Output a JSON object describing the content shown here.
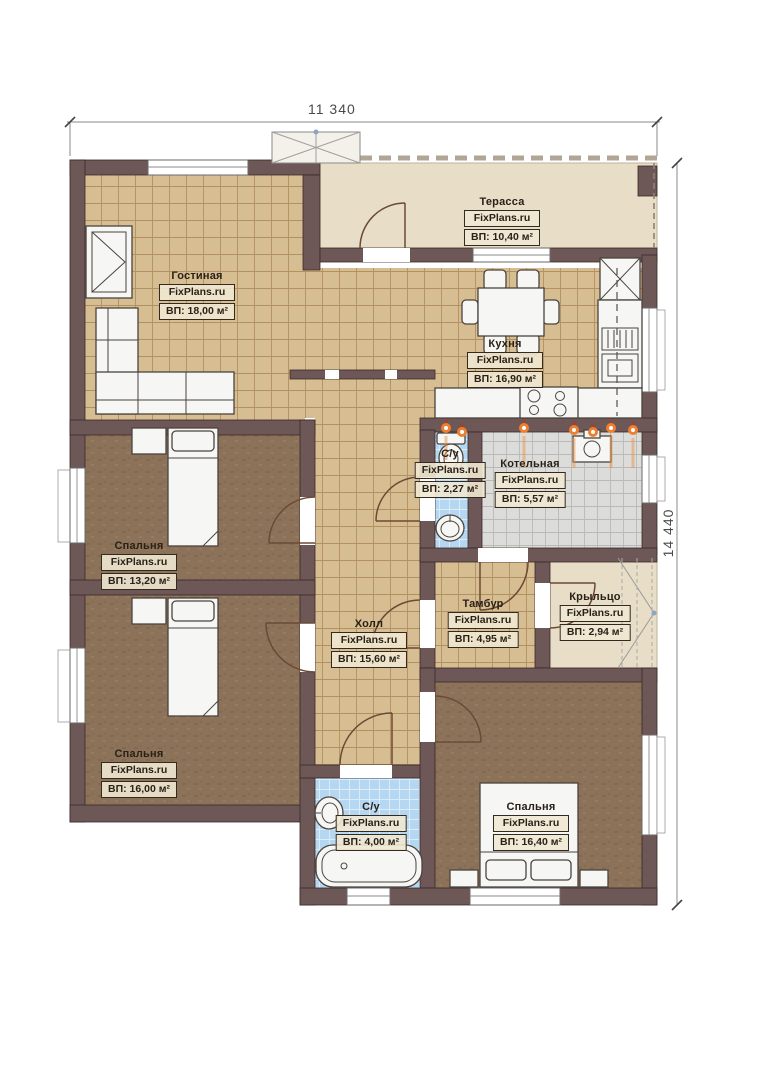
{
  "dimensions": {
    "width": "11 340",
    "height": "14 440"
  },
  "rooms": [
    {
      "name": "Гостиная",
      "brand": "FixPlans.ru",
      "area": "ВП: 18,00 м²"
    },
    {
      "name": "Терасса",
      "brand": "FixPlans.ru",
      "area": "ВП: 10,40 м²"
    },
    {
      "name": "Кухня",
      "brand": "FixPlans.ru",
      "area": "ВП: 16,90 м²"
    },
    {
      "name": "С/у",
      "brand": "FixPlans.ru",
      "area": "ВП: 2,27 м²"
    },
    {
      "name": "Котельная",
      "brand": "FixPlans.ru",
      "area": "ВП: 5,57 м²"
    },
    {
      "name": "Спальня",
      "brand": "FixPlans.ru",
      "area": "ВП: 13,20 м²"
    },
    {
      "name": "Холл",
      "brand": "FixPlans.ru",
      "area": "ВП: 15,60 м²"
    },
    {
      "name": "Тамбур",
      "brand": "FixPlans.ru",
      "area": "ВП: 4,95 м²"
    },
    {
      "name": "Крыльцо",
      "brand": "FixPlans.ru",
      "area": "ВП: 2,94 м²"
    },
    {
      "name": "Спальня",
      "brand": "FixPlans.ru",
      "area": "ВП: 16,00 м²"
    },
    {
      "name": "С/у",
      "brand": "FixPlans.ru",
      "area": "ВП: 4,00 м²"
    },
    {
      "name": "Спальня",
      "brand": "FixPlans.ru",
      "area": "ВП: 16,40 м²"
    }
  ],
  "colors": {
    "wall": "#6e5757",
    "wall_stroke": "#3a2a2a",
    "tile": "#d7bd92",
    "tile_line": "#b3905f",
    "bedroom": "#8c7258",
    "bath": "#b6d7f2",
    "bath_line": "#ddeefb",
    "boiler": "#dcdcda",
    "boiler_line": "#b9b9b6",
    "terrace": "#e8ddc7",
    "furniture": "#f6f6f4",
    "furn_stroke": "#4a443e",
    "door": "#6b4a35",
    "flame": "#ef7f2e",
    "label_bg": "rgba(240,232,210,0.9)",
    "ink": "#2a2118"
  }
}
